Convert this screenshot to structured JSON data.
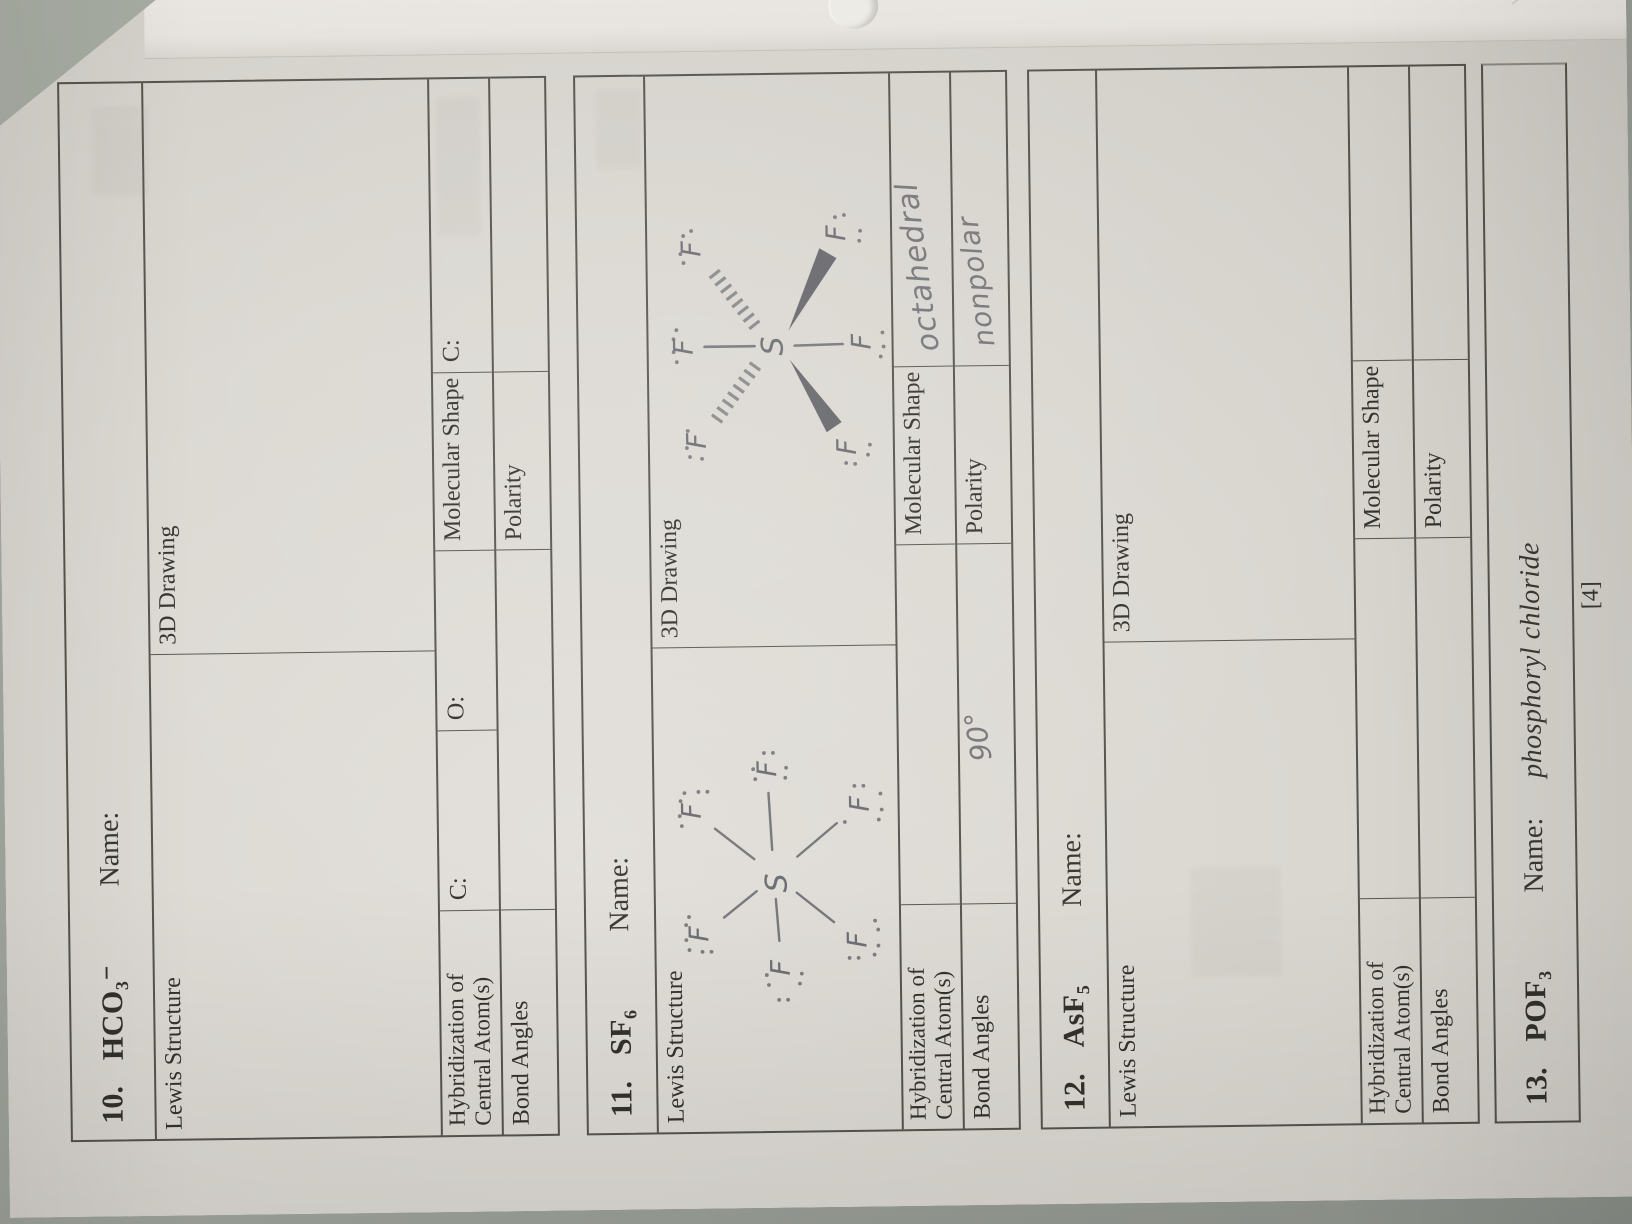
{
  "photo": {
    "footer_page_number": "[4]"
  },
  "labels": {
    "lewis_structure": "Lewis Structure",
    "three_d_drawing": "3D Drawing",
    "hybridization_line1": "Hybridization of",
    "hybridization_line2": "Central Atom(s)",
    "molecular_shape": "Molecular Shape",
    "bond_angles": "Bond Angles",
    "polarity": "Polarity",
    "name_label": "Name:"
  },
  "problems": {
    "p10": {
      "number": "10.",
      "formula": "HCO₃⁻",
      "hybrid_slot_c": "C:",
      "hybrid_slot_o": "O:",
      "shape_slot_c": "C:"
    },
    "p11": {
      "number": "11.",
      "formula": "SF₆",
      "handwritten": {
        "molecular_shape": "octahedral",
        "bond_angles": "90°",
        "polarity": "nonpolar"
      }
    },
    "p12": {
      "number": "12.",
      "formula": "AsF₅"
    },
    "p13": {
      "number": "13.",
      "formula": "POF₃",
      "name_value": "phosphoryl chloride"
    }
  },
  "atoms": {
    "sulfur": "S",
    "fluorine": "F"
  }
}
